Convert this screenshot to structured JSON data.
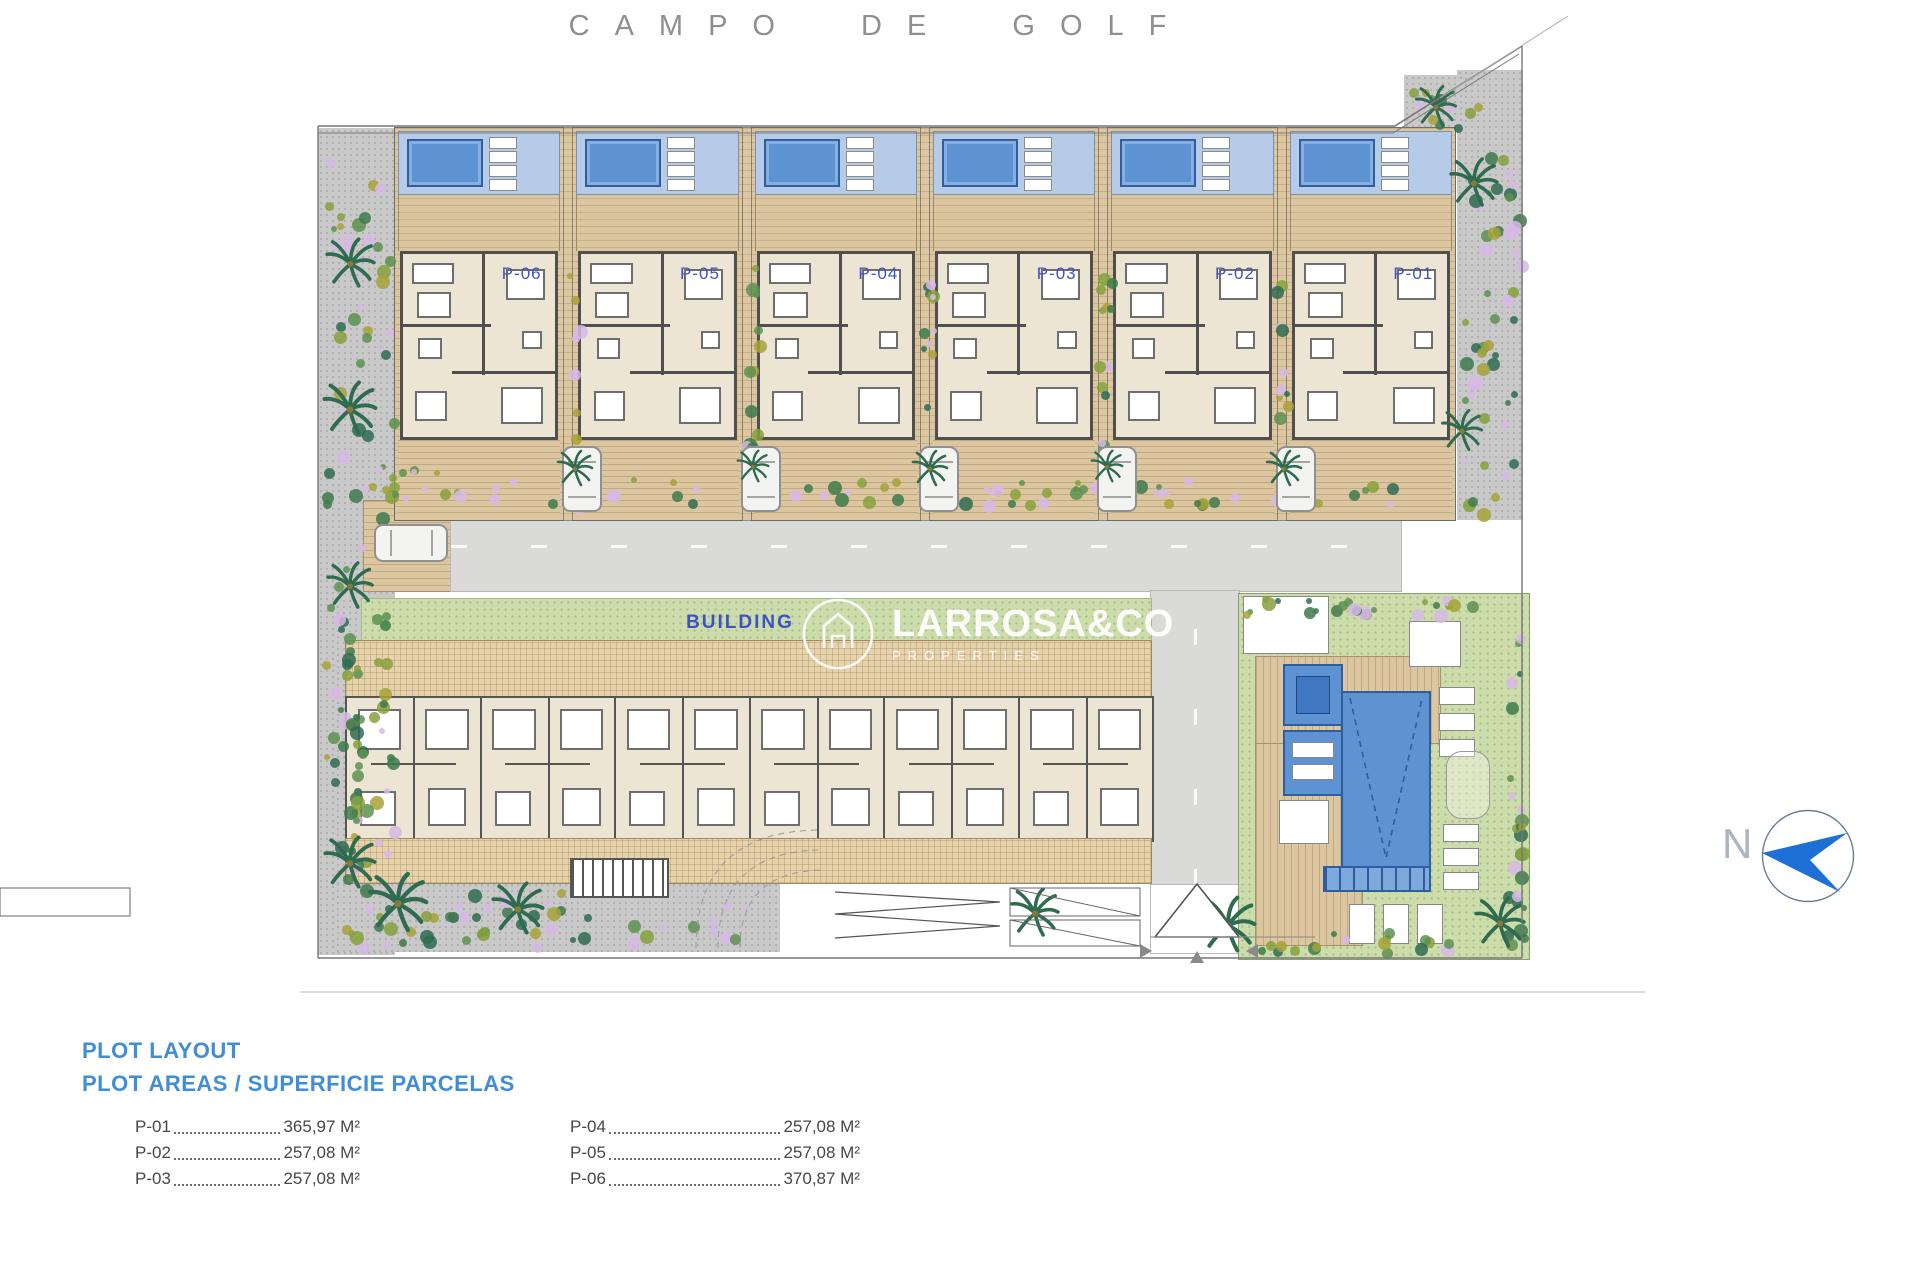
{
  "title": "CAMPO DE GOLF",
  "plots": [
    {
      "label": "P-06"
    },
    {
      "label": "P-05"
    },
    {
      "label": "P-04"
    },
    {
      "label": "P-03"
    },
    {
      "label": "P-02"
    },
    {
      "label": "P-01"
    }
  ],
  "building_label": "BUILDING",
  "watermark": {
    "name": "LARROSA&CO",
    "subtitle": "PROPERTIES"
  },
  "north": {
    "label": "N"
  },
  "legend": {
    "title": "PLOT LAYOUT",
    "subtitle": "PLOT AREAS / SUPERFICIE PARCELAS",
    "columns": [
      [
        {
          "plot": "P-01",
          "area": "365,97 M²"
        },
        {
          "plot": "P-02",
          "area": "257,08 M²"
        },
        {
          "plot": "P-03",
          "area": "257,08 M²"
        }
      ],
      [
        {
          "plot": "P-04",
          "area": "257,08 M²"
        },
        {
          "plot": "P-05",
          "area": "257,08 M²"
        },
        {
          "plot": "P-06",
          "area": "370,87 M²"
        }
      ]
    ]
  },
  "colors": {
    "pool_blue": "#5e93d3",
    "pool_deck": "#b6cbe7",
    "wood_deck": "#dcc69f",
    "floor_cream": "#ece5d3",
    "lawn_green": "#cddcab",
    "road_gray": "#dadad8",
    "gravel_gray": "#c9c9c9",
    "accent_blue": "#3d53c4",
    "legend_blue": "#3f8ed6",
    "north_blue": "#1e6fd6"
  }
}
